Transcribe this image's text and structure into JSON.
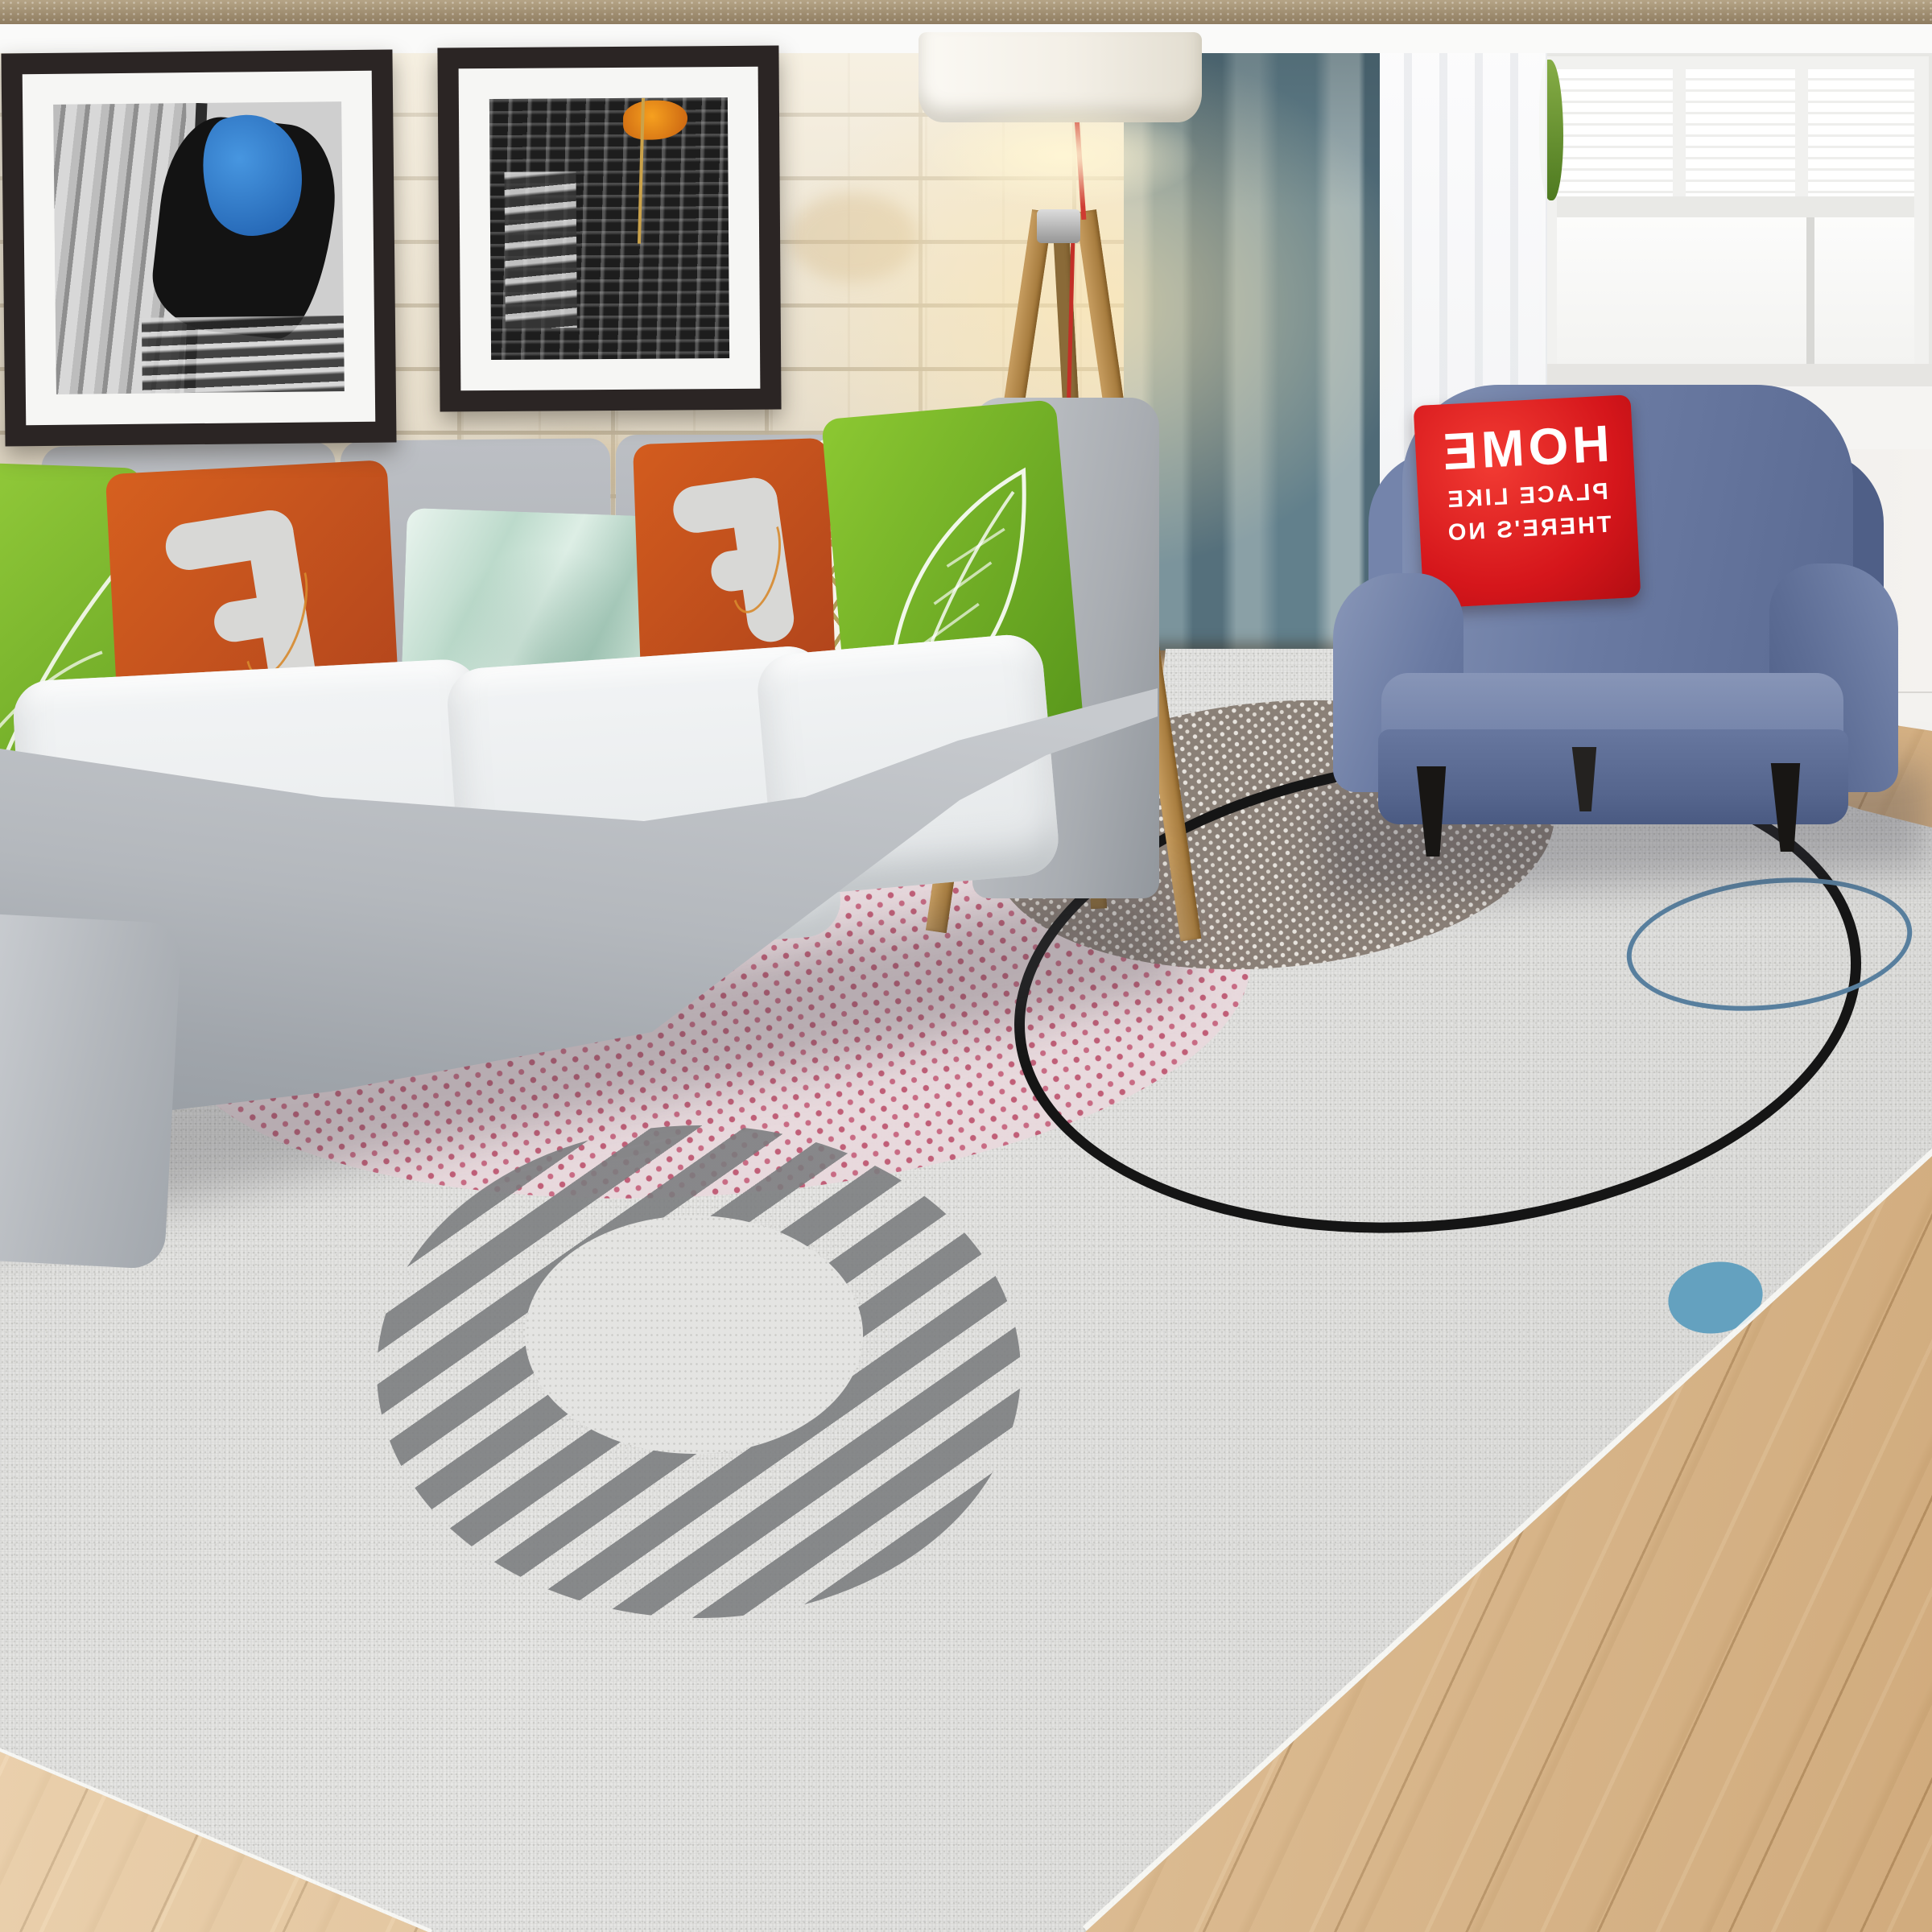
{
  "armchair_pillow": {
    "line1": "HOME",
    "line2": "PLACE LIKE",
    "line3": "THERE'S NO",
    "text_mirrored": true
  },
  "palette": {
    "rug_base": "#e5e4e2",
    "rug_pink_dot_circle": "#c05a74",
    "rug_brown_dot_circle": "#887d74",
    "rug_black_ring": "#151515",
    "rug_blue_ring": "#587f9e",
    "rug_blue_dot": "#64a1bf",
    "rug_stripe_gray": "#7d7f80",
    "sofa_gray": "#b4b8bd",
    "seat_cushion_white": "#eef0f1",
    "pillow_orange": "#cd5520",
    "pillow_green": "#7ab62e",
    "pillow_mint": "#cfe6dc",
    "armchair_blue": "#6b7ba3",
    "pillow_red": "#d5161b",
    "curtain_teal": "#6f8a94",
    "brick_cream": "#ece4d3",
    "wood_floor": "#d9b98c",
    "frame_dark": "#2b2524",
    "lamp_wood": "#b5894e",
    "lamp_cord_red": "#c32f27"
  },
  "objects": [
    "brick wall",
    "two framed gondola photos",
    "gray sofa with pillows",
    "wooden tripod floor lamp",
    "teal curtain",
    "sheer curtain",
    "window",
    "blue armchair with red HOME pillow",
    "geometric gray area rug",
    "wooden floor"
  ]
}
